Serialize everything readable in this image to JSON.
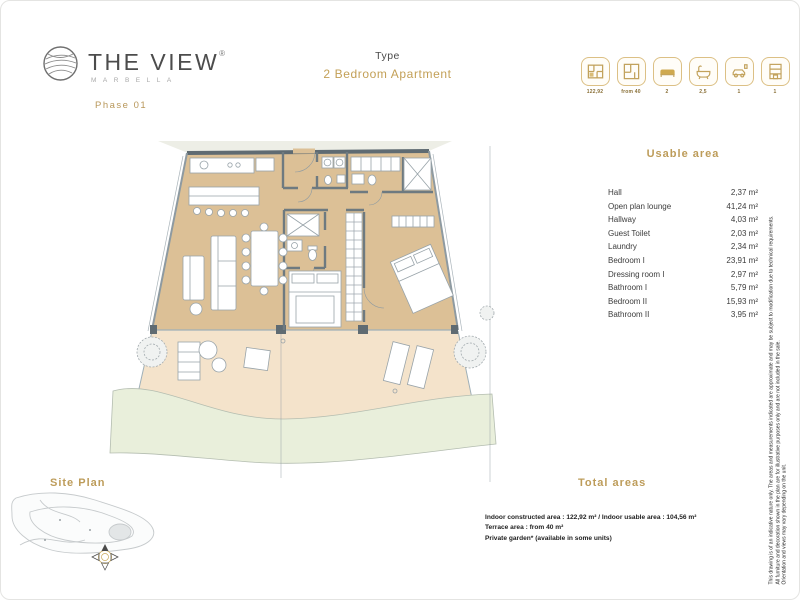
{
  "brand": {
    "name": "THE VIEW",
    "registered": "®",
    "subtitle": "MARBELLA",
    "phase": "Phase 01"
  },
  "header": {
    "type_label": "Type",
    "type_value": "2 Bedroom Apartment"
  },
  "spec_icons": [
    {
      "name": "constructed-area",
      "label": "122,92"
    },
    {
      "name": "terrace-area",
      "label": "from 40"
    },
    {
      "name": "bedrooms",
      "label": "2"
    },
    {
      "name": "bathrooms",
      "label": "2,5"
    },
    {
      "name": "parking",
      "label": "1"
    },
    {
      "name": "storage",
      "label": "1"
    }
  ],
  "usable_area": {
    "title": "Usable area",
    "rows": [
      {
        "label": "Hall",
        "value": "2,37 m²"
      },
      {
        "label": "Open plan lounge",
        "value": "41,24 m²"
      },
      {
        "label": "Hallway",
        "value": "4,03 m²"
      },
      {
        "label": "Guest Toilet",
        "value": "2,03 m²"
      },
      {
        "label": "Laundry",
        "value": "2,34 m²"
      },
      {
        "label": "Bedroom I",
        "value": "23,91 m²"
      },
      {
        "label": "Dressing room I",
        "value": "2,97 m²"
      },
      {
        "label": "Bathroom I",
        "value": "5,79 m²"
      },
      {
        "label": "Bedroom II",
        "value": "15,93 m²"
      },
      {
        "label": "Bathroom II",
        "value": "3,95 m²"
      }
    ]
  },
  "total_areas": {
    "title": "Total areas",
    "lines": [
      "Indoor constructed area : 122,92 m² / Indoor usable area : 104,56 m²",
      "Terrace area : from 40 m²",
      "Private garden* (available in some units)"
    ]
  },
  "site_plan": {
    "title": "Site Plan"
  },
  "disclaimer": {
    "lines": [
      "This drawing is of an indicative nature only. The areas and measurements indicated are approximate and may be subject to modification due to technical requirements.",
      "All furniture and decoration shown in the plan are for illustrative purposes only and are not included in the sale.",
      "Orientation and views may vary depending on the unit."
    ]
  },
  "colors": {
    "gold": "#bd9c5a",
    "floor": "#dcc096",
    "terrace": "#f4e3cb",
    "garden": "#e9efdb",
    "wall": "#5f6b72"
  }
}
